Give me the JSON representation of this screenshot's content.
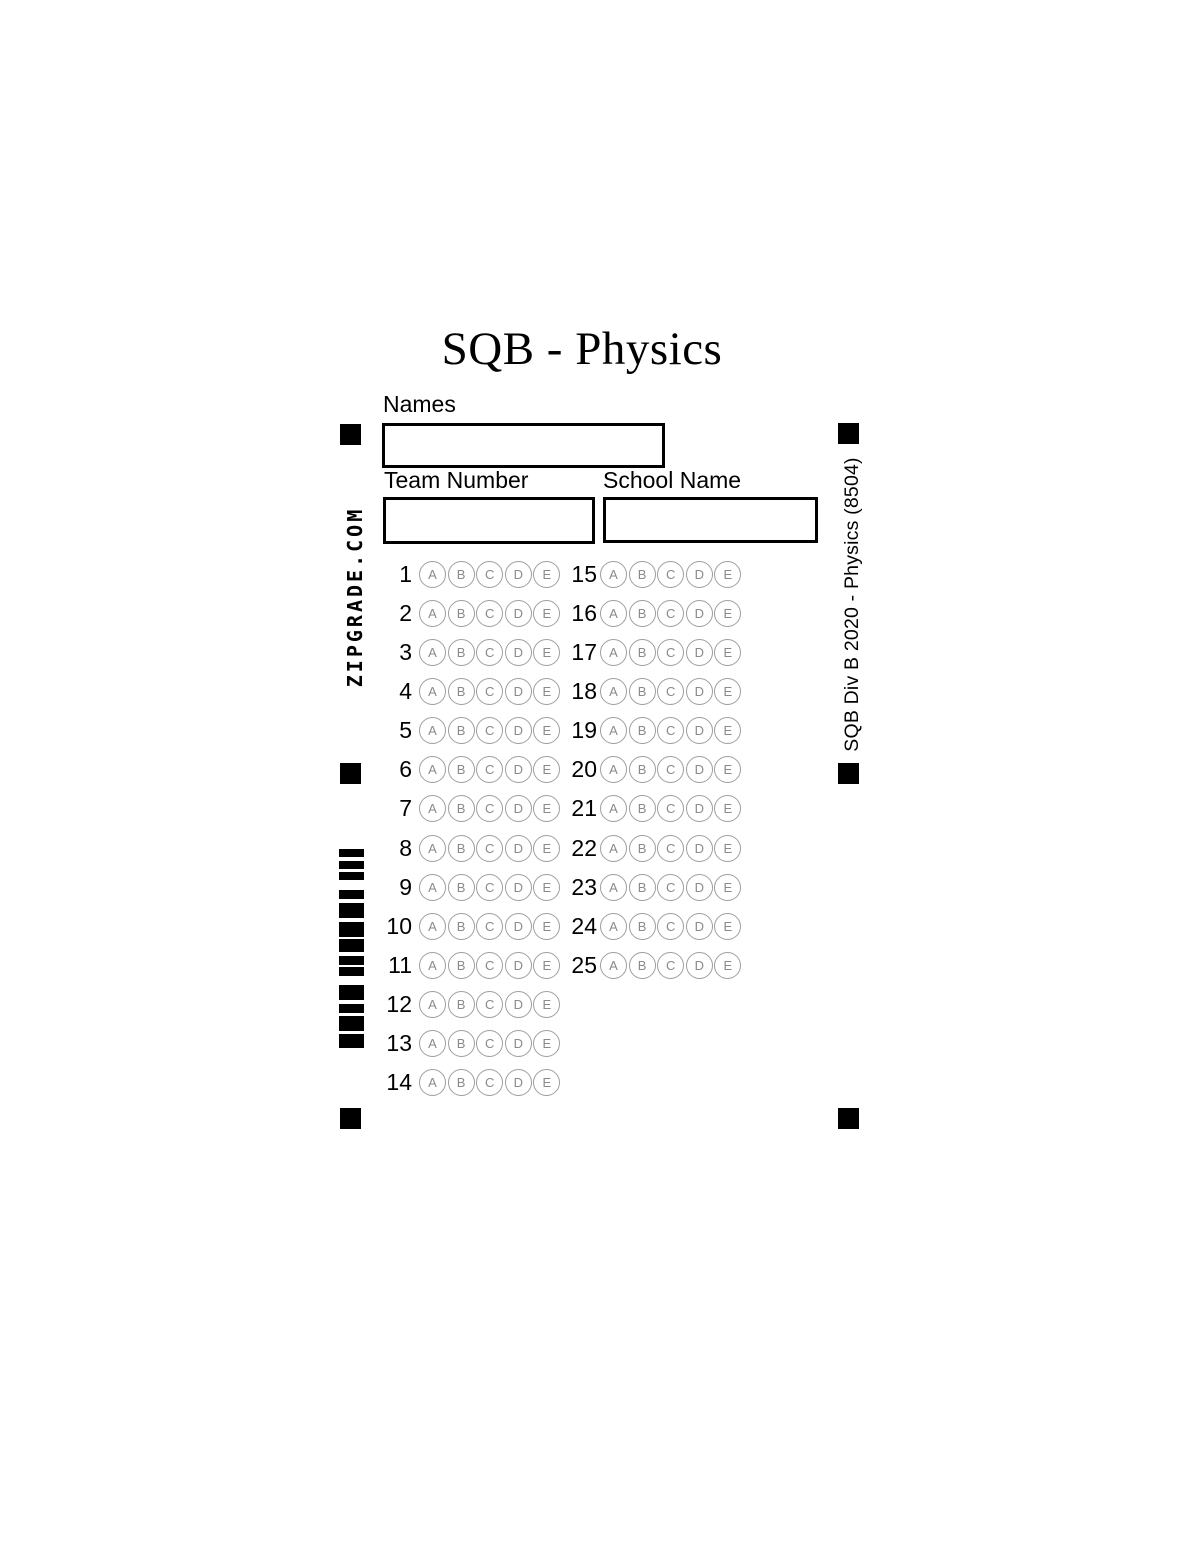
{
  "page": {
    "title": "SQB - Physics"
  },
  "form": {
    "names_label": "Names",
    "names_value": "",
    "team_label": "Team Number",
    "team_value": "",
    "school_label": "School Name",
    "school_value": ""
  },
  "side": {
    "left_vertical_text": "ZIPGRADE.COM",
    "right_vertical_text": "SQB Div B 2020 - Physics (8504)"
  },
  "answer_grid": {
    "choices": [
      "A",
      "B",
      "C",
      "D",
      "E"
    ],
    "left_column_questions": [
      1,
      2,
      3,
      4,
      5,
      6,
      7,
      8,
      9,
      10,
      11,
      12,
      13,
      14
    ],
    "right_column_questions": [
      15,
      16,
      17,
      18,
      19,
      20,
      21,
      22,
      23,
      24,
      25
    ]
  },
  "barcode_bars": [
    {
      "y": 849,
      "h": 8
    },
    {
      "y": 861,
      "h": 8
    },
    {
      "y": 872,
      "h": 8
    },
    {
      "y": 890,
      "h": 9
    },
    {
      "y": 903,
      "h": 15
    },
    {
      "y": 922,
      "h": 15
    },
    {
      "y": 939,
      "h": 13
    },
    {
      "y": 956,
      "h": 9
    },
    {
      "y": 967,
      "h": 9
    },
    {
      "y": 985,
      "h": 15
    },
    {
      "y": 1004,
      "h": 9
    },
    {
      "y": 1016,
      "h": 15
    },
    {
      "y": 1034,
      "h": 14
    }
  ],
  "colors": {
    "ink": "#000000",
    "bubble_outline": "#9e9e9e",
    "bubble_letter": "#8a8a8a"
  }
}
